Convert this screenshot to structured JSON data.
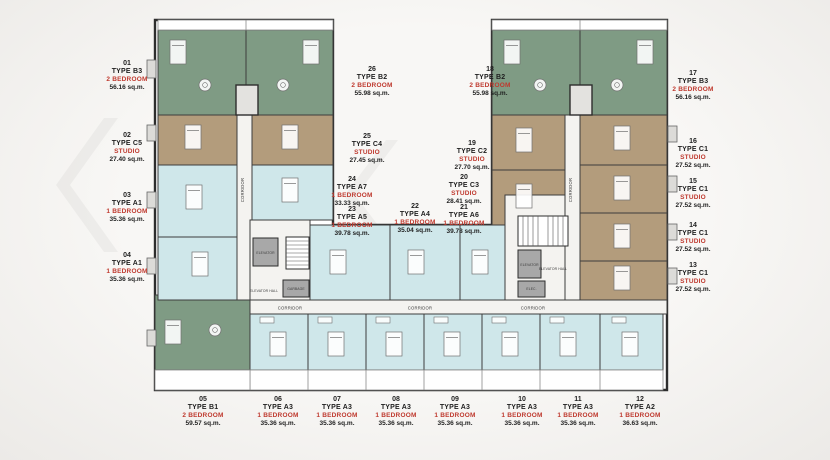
{
  "title": "Residential floor plan",
  "colors": {
    "two_bedroom_green": "#7f9b84",
    "studio_tan": "#b39c7c",
    "one_bedroom_blue": "#cfe7ea",
    "label_red": "#bf3a2f",
    "wall": "#2d2d2d",
    "service_gray": "#a8a8a8",
    "background": "#f2f1ee"
  },
  "units": [
    {
      "no": "01",
      "type": "TYPE B3",
      "category": "2 BEDROOM",
      "area": "56.16 sq.m."
    },
    {
      "no": "02",
      "type": "TYPE C5",
      "category": "STUDIO",
      "area": "27.40 sq.m."
    },
    {
      "no": "03",
      "type": "TYPE A1",
      "category": "1 BEDROOM",
      "area": "35.36 sq.m."
    },
    {
      "no": "04",
      "type": "TYPE A1",
      "category": "1 BEDROOM",
      "area": "35.36 sq.m."
    },
    {
      "no": "05",
      "type": "TYPE B1",
      "category": "2 BEDROOM",
      "area": "59.57 sq.m."
    },
    {
      "no": "06",
      "type": "TYPE A3",
      "category": "1 BEDROOM",
      "area": "35.36 sq.m."
    },
    {
      "no": "07",
      "type": "TYPE A3",
      "category": "1 BEDROOM",
      "area": "35.36 sq.m."
    },
    {
      "no": "08",
      "type": "TYPE A3",
      "category": "1 BEDROOM",
      "area": "35.36 sq.m."
    },
    {
      "no": "09",
      "type": "TYPE A3",
      "category": "1 BEDROOM",
      "area": "35.36 sq.m."
    },
    {
      "no": "10",
      "type": "TYPE A3",
      "category": "1 BEDROOM",
      "area": "35.36 sq.m."
    },
    {
      "no": "11",
      "type": "TYPE A3",
      "category": "1 BEDROOM",
      "area": "35.36 sq.m."
    },
    {
      "no": "12",
      "type": "TYPE A2",
      "category": "1 BEDROOM",
      "area": "36.63 sq.m."
    },
    {
      "no": "13",
      "type": "TYPE C1",
      "category": "STUDIO",
      "area": "27.52 sq.m."
    },
    {
      "no": "14",
      "type": "TYPE C1",
      "category": "STUDIO",
      "area": "27.52 sq.m."
    },
    {
      "no": "15",
      "type": "TYPE C1",
      "category": "STUDIO",
      "area": "27.52 sq.m."
    },
    {
      "no": "16",
      "type": "TYPE C1",
      "category": "STUDIO",
      "area": "27.52 sq.m."
    },
    {
      "no": "17",
      "type": "TYPE B3",
      "category": "2 BEDROOM",
      "area": "56.16 sq.m."
    },
    {
      "no": "18",
      "type": "TYPE B2",
      "category": "2 BEDROOM",
      "area": "55.98 sq.m."
    },
    {
      "no": "19",
      "type": "TYPE C2",
      "category": "STUDIO",
      "area": "27.70 sq.m."
    },
    {
      "no": "20",
      "type": "TYPE C3",
      "category": "STUDIO",
      "area": "28.41 sq.m."
    },
    {
      "no": "21",
      "type": "TYPE A6",
      "category": "1 BEDROOM",
      "area": "39.78 sq.m."
    },
    {
      "no": "22",
      "type": "TYPE A4",
      "category": "1 BEDROOM",
      "area": "35.04 sq.m."
    },
    {
      "no": "23",
      "type": "TYPE A5",
      "category": "1 BEDROOM",
      "area": "39.78 sq.m."
    },
    {
      "no": "24",
      "type": "TYPE A7",
      "category": "1 BEDROOM",
      "area": "33.33 sq.m."
    },
    {
      "no": "25",
      "type": "TYPE C4",
      "category": "STUDIO",
      "area": "27.45 sq.m."
    },
    {
      "no": "26",
      "type": "TYPE B2",
      "category": "2 BEDROOM",
      "area": "55.98 sq.m."
    }
  ],
  "plan": {
    "annotations": [
      {
        "id": "elevator-left",
        "text": "ELEVATOR"
      },
      {
        "id": "elevator-hall-left",
        "text": "ELEVATOR HALL"
      },
      {
        "id": "garbage",
        "text": "GARBAGE"
      },
      {
        "id": "elevator-right",
        "text": "ELEVATOR"
      },
      {
        "id": "elevator-hall-right",
        "text": "ELEVATOR HALL"
      },
      {
        "id": "elec-room",
        "text": "ELEC."
      },
      {
        "id": "corridor-left-vertical",
        "text": "CORRIDOR"
      },
      {
        "id": "corridor-right-vertical",
        "text": "CORRIDOR"
      },
      {
        "id": "corridor-bottom-1",
        "text": "CORRIDOR"
      },
      {
        "id": "corridor-bottom-2",
        "text": "CORRIDOR"
      },
      {
        "id": "corridor-bottom-3",
        "text": "CORRIDOR"
      }
    ]
  }
}
